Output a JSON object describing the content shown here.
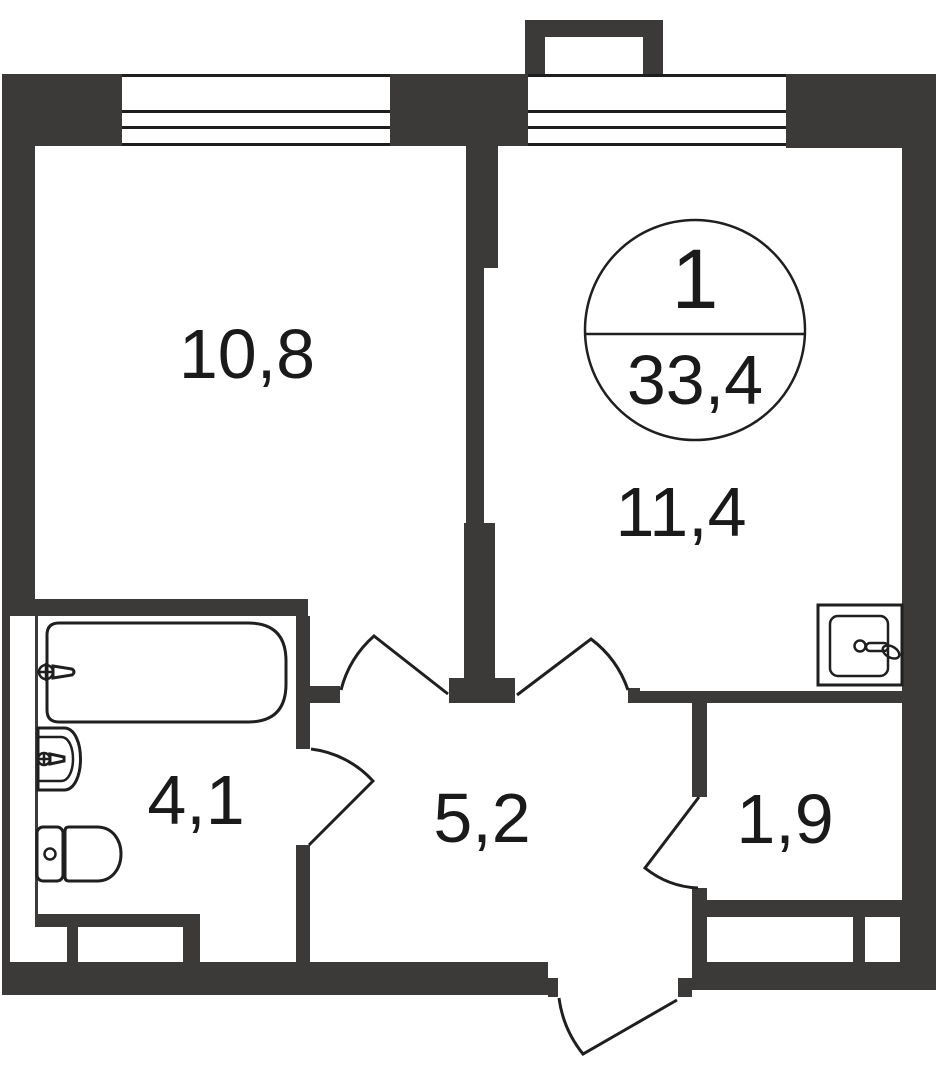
{
  "floorplan": {
    "unit": {
      "number": "1",
      "total_area": "33,4"
    },
    "rooms": [
      {
        "name": "room-top-left",
        "area": "10,8"
      },
      {
        "name": "room-top-right",
        "area": "11,4"
      },
      {
        "name": "bathroom",
        "area": "4,1"
      },
      {
        "name": "hallway",
        "area": "5,2"
      },
      {
        "name": "storage",
        "area": "1,9"
      }
    ],
    "fixtures": [
      "bathtub",
      "wash-basin",
      "toilet",
      "kitchen-sink"
    ],
    "colors": {
      "wall": "#3b3a39",
      "line": "#1f1f1f",
      "text": "#1a1a1a",
      "background": "#ffffff"
    }
  }
}
